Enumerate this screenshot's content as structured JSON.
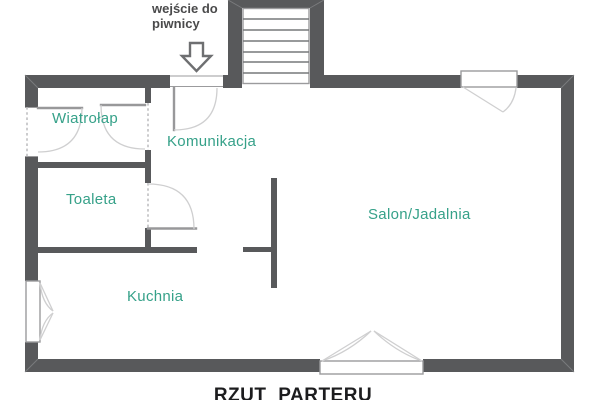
{
  "plan": {
    "title": "RZUT PARTERU",
    "basement_note": {
      "line1": "wejście do",
      "line2": "piwnicy"
    },
    "rooms": {
      "wiatrolap": {
        "label": "Wiatrołap"
      },
      "komunikacja": {
        "label": "Komunikacja"
      },
      "toaleta": {
        "label": "Toaleta"
      },
      "kuchnia": {
        "label": "Kuchnia"
      },
      "salon_jadalnia": {
        "label": "Salon/Jadalnia"
      }
    },
    "icons": {
      "basement_arrow": "down-arrow-icon",
      "stairs": "stairs-symbol"
    },
    "colors": {
      "wall": "#58595B",
      "room_label": "#36A189",
      "annotation": "#4A4A4B",
      "title": "#1C1C1E",
      "door_line": "#98989A",
      "swing_arc": "#CFCFD0",
      "window_frame": "#9B9B9D",
      "stair_tread": "#77787A",
      "dashed_opening": "#B7B7B9"
    }
  }
}
